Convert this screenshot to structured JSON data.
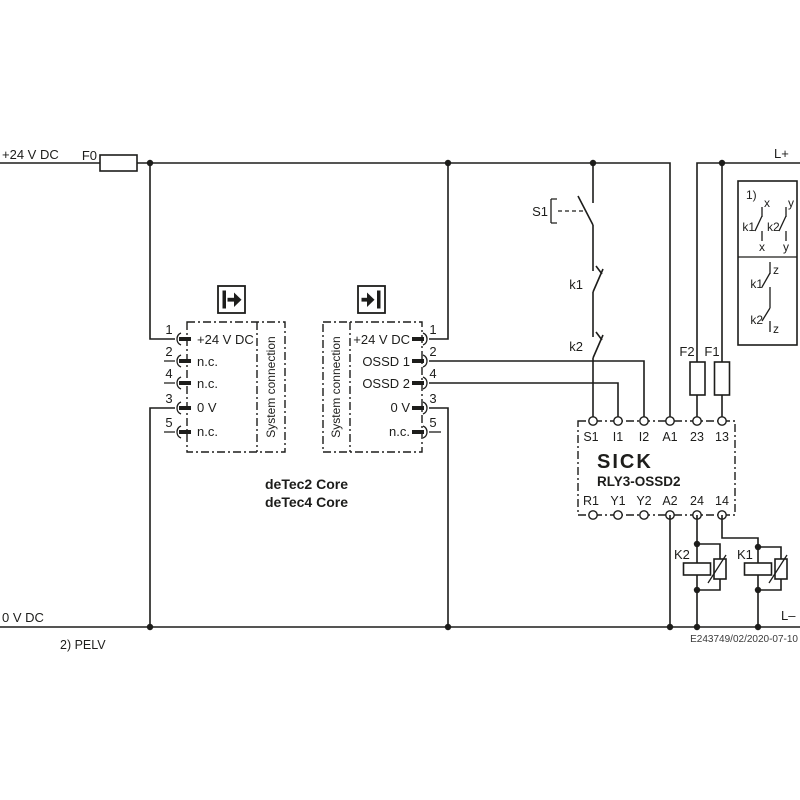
{
  "diagram": {
    "background": "#ffffff",
    "line_color": "#1d1d1b"
  },
  "power": {
    "plus24": "+24 V DC",
    "zero_v": "0 V DC",
    "l_plus": "L+",
    "l_minus": "L–",
    "fuse_f0": "F0"
  },
  "sender": {
    "system_connection": "System connection",
    "pins": [
      {
        "num": "1",
        "label": "+24 V DC"
      },
      {
        "num": "2",
        "label": "n.c."
      },
      {
        "num": "4",
        "label": "n.c."
      },
      {
        "num": "3",
        "label": "0 V"
      },
      {
        "num": "5",
        "label": "n.c."
      }
    ]
  },
  "receiver": {
    "system_connection": "System connection",
    "pins": [
      {
        "num": "1",
        "label": "+24 V DC"
      },
      {
        "num": "2",
        "label": "OSSD 1"
      },
      {
        "num": "4",
        "label": "OSSD 2"
      },
      {
        "num": "3",
        "label": "0 V"
      },
      {
        "num": "5",
        "label": "n.c."
      }
    ]
  },
  "devices": {
    "line1": "deTec2 Core",
    "line2": "deTec4 Core"
  },
  "control": {
    "s1": "S1",
    "k1": "k1",
    "k2": "k2",
    "f2": "F2",
    "f1": "F1"
  },
  "relay": {
    "brand": "SICK",
    "model": "RLY3-OSSD2",
    "top_terminals": [
      "S1",
      "I1",
      "I2",
      "A1",
      "23",
      "13"
    ],
    "bottom_terminals": [
      "R1",
      "Y1",
      "Y2",
      "A2",
      "24",
      "14"
    ]
  },
  "contactors": {
    "k2": "K2",
    "k1": "K1"
  },
  "legend": {
    "note": "1)",
    "x_top": "x",
    "y_top": "y",
    "x_bottom": "x",
    "y_bottom": "y",
    "k1_upper": "k1",
    "k2_upper": "k2",
    "z_top": "z",
    "z_bottom": "z",
    "k1_lower": "k1",
    "k2_lower": "k2"
  },
  "notes": {
    "pelv": "2) PELV",
    "doc_id": "E243749/02/2020-07-10"
  }
}
